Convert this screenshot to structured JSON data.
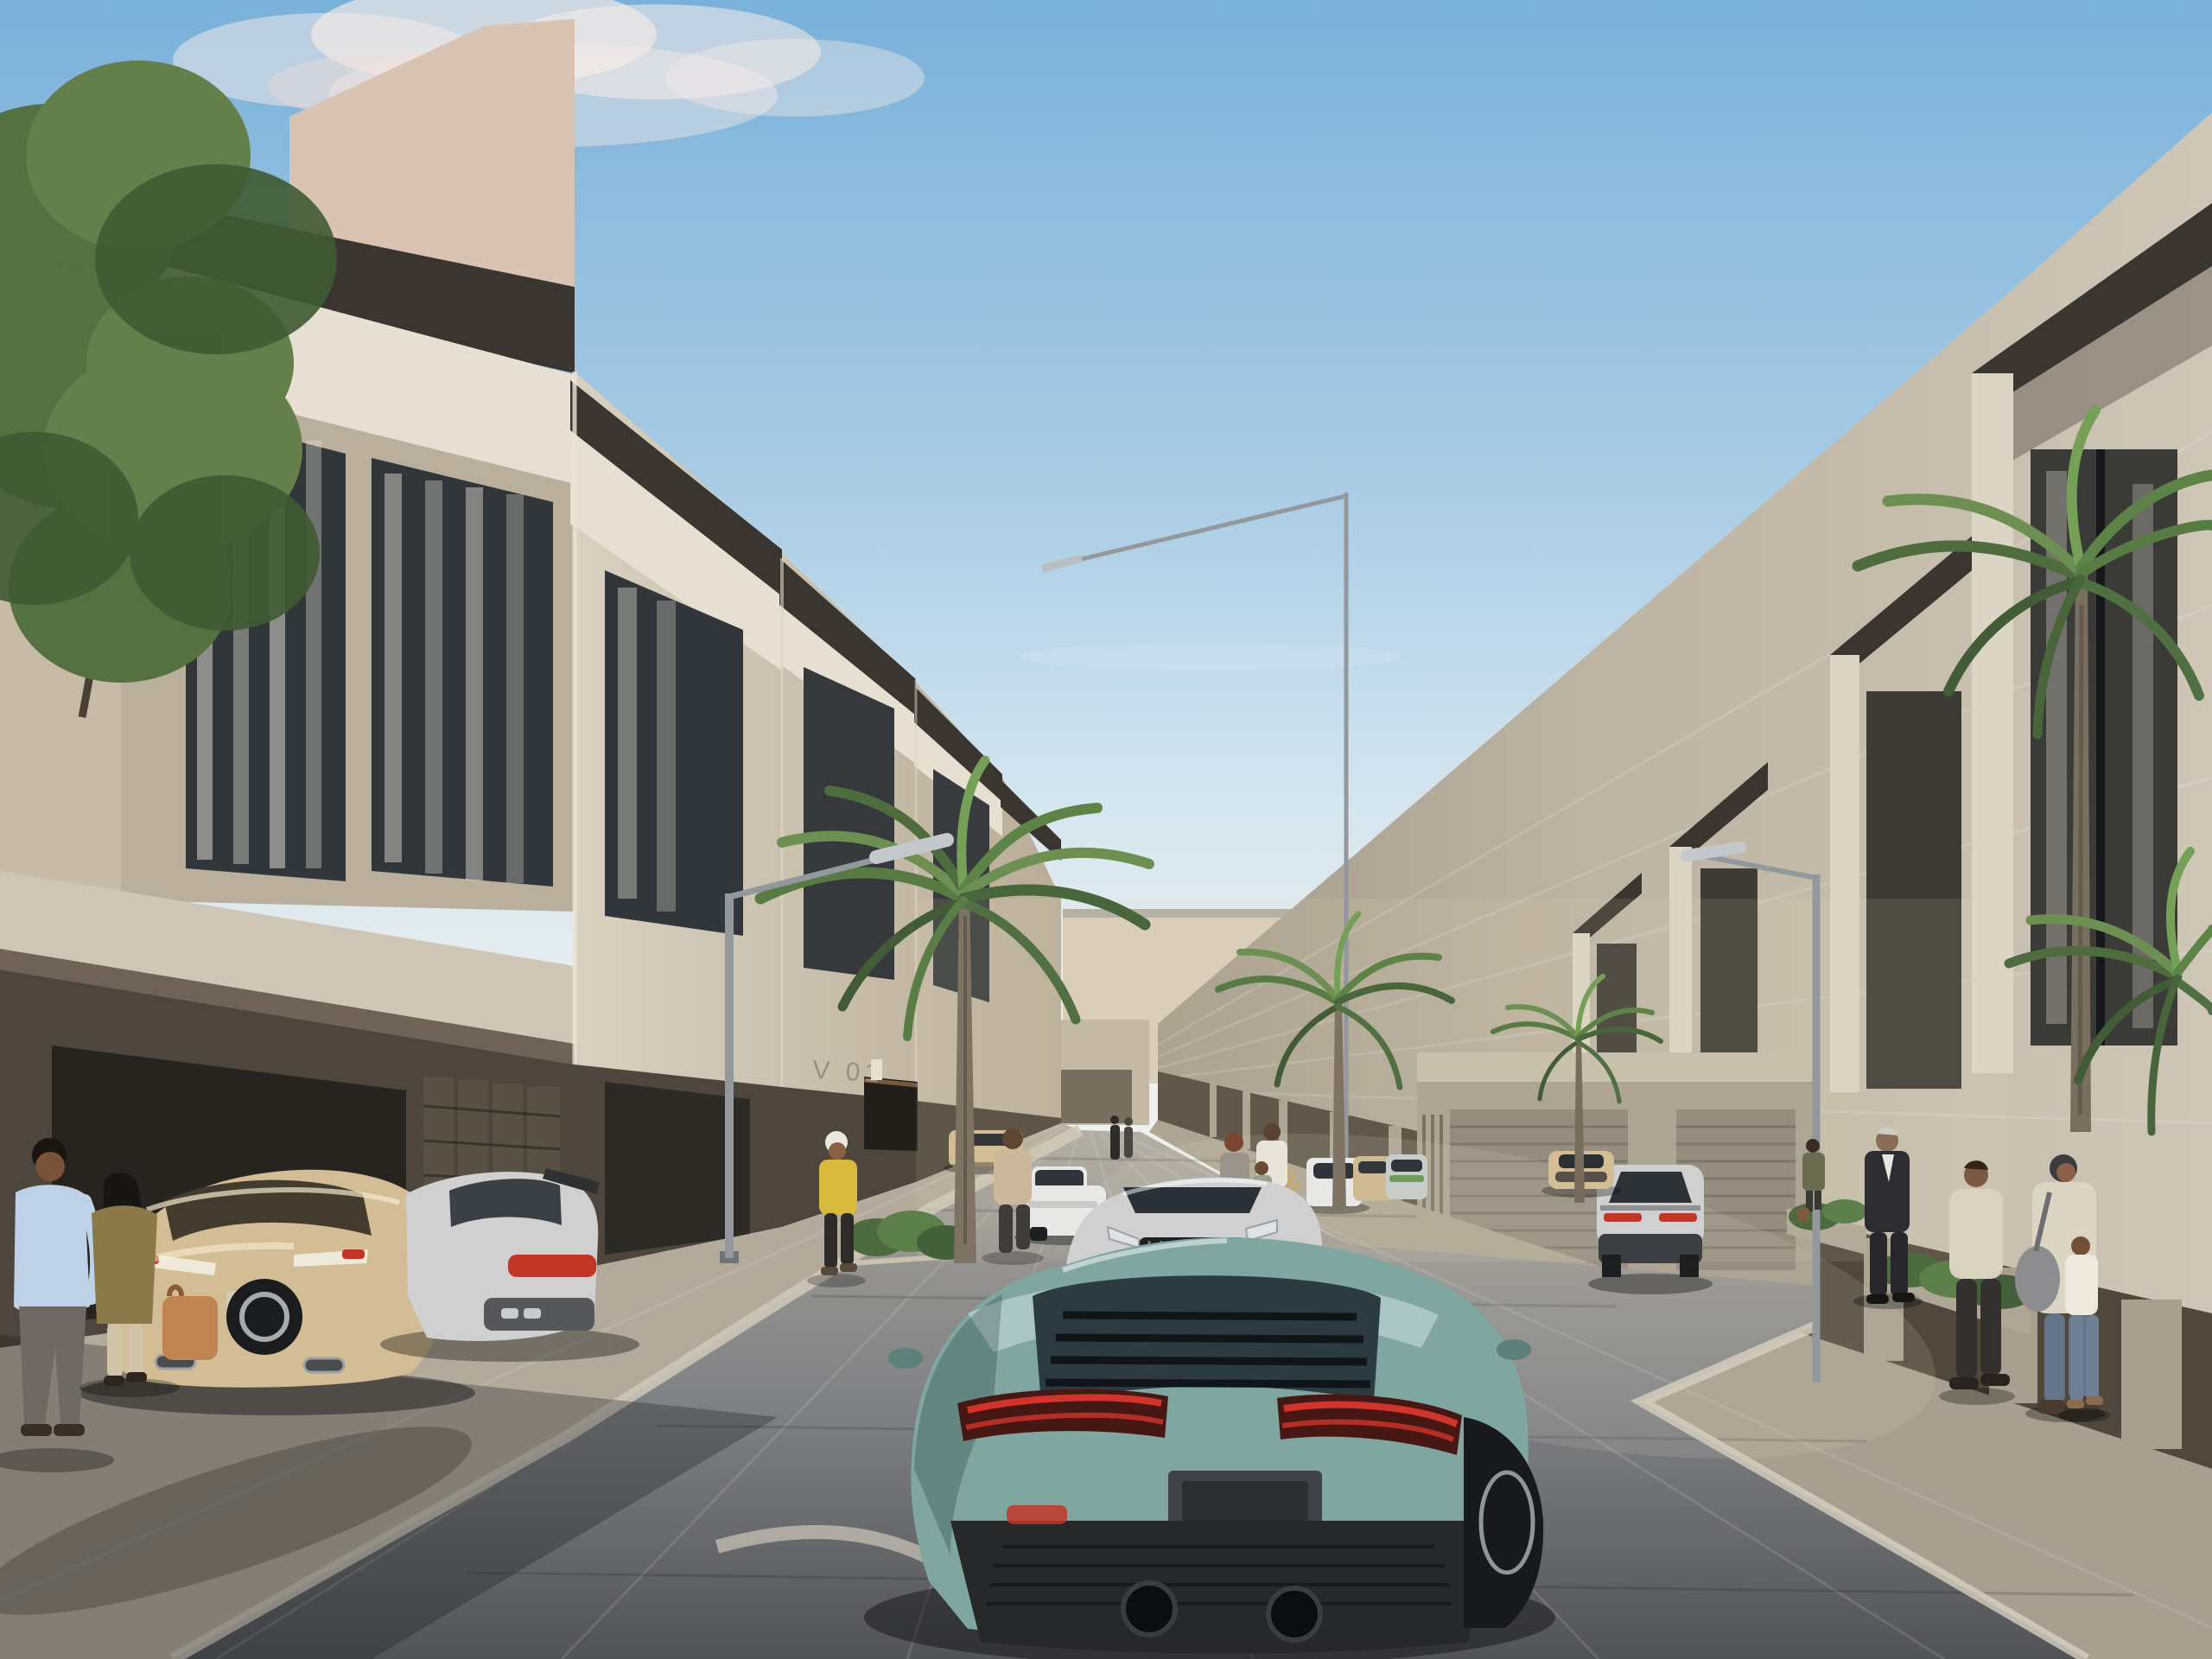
{
  "scene": {
    "type": "photorealistic architectural rendering",
    "title": "Modern villa street rendering",
    "description": "Sunlit residential street lined with modern limestone townhouses with dark pergola roof canopies. A teal sports car drives up the paved road; luxury cars are parked in carports and along the curb; pedestrians walk both sidewalks; palm trees and a leafy tree frame the view; a flock of birds flies in the blue sky above the far garages.",
    "time_of_day": "daytime",
    "weather": "clear blue sky with soft clouds"
  },
  "signs": {
    "unit_label": "V 01",
    "unit_label_location": "dark stone entrance wall of first villa",
    "far_plaques": 2
  },
  "colors": {
    "sky_top": "#7ab1da",
    "sky_horizon": "#edf1f0",
    "cloud": "#f7ece7",
    "stone_light": "#d9d0c0",
    "stone_parapet": "#e7e0d2",
    "stone_shadow": "#b3a794",
    "stucco_top": "#d9c3b2",
    "pergola_dark": "#3a352e",
    "cladding_dark": "#4e463c",
    "right_facade": "#cfc6b7",
    "arcade_dark": "#51483d",
    "pier_stone": "#a99f8f",
    "end_wall": "#a79d8e",
    "garage_door": "#8d8478",
    "distant_wall": "#d8ccba",
    "road_near": "#515357",
    "road_far": "#b2ada3",
    "sidewalk_left": "#b3aa9b",
    "sidewalk_right": "#a89f90",
    "curb": "#d3ccbd",
    "palm_green": "#5f7f46",
    "palm_dark": "#415c37",
    "tree_green": "#5d7c49",
    "car_teal": "#7fa6a1",
    "car_silver": "#cfd0cf",
    "car_champagne": "#d3bd94",
    "car_white": "#e8e9e7",
    "taillight_red": "#c23527",
    "lamp_metal": "#93989c"
  },
  "vehicles": [
    {
      "name": "teal-sports-car",
      "color": "sage teal",
      "position": "foreground center, driving away"
    },
    {
      "name": "silver-sedan",
      "color": "silver",
      "position": "mid street, facing viewer"
    },
    {
      "name": "white-suv",
      "color": "white",
      "position": "parked at left curb"
    },
    {
      "name": "champagne-coupe",
      "color": "champagne gold",
      "position": "foreground left carport"
    },
    {
      "name": "silver-coupe",
      "color": "silver",
      "position": "foreground left carport, beside coupe"
    },
    {
      "name": "gold-sports-car",
      "color": "gold",
      "position": "far end near garages, facing viewer"
    },
    {
      "name": "silver-fastback",
      "color": "silver",
      "position": "far end, driving toward garages"
    },
    {
      "name": "parked-row",
      "color": "white, champagne and green",
      "position": "right side in the distance"
    },
    {
      "name": "distant-parked-car",
      "color": "champagne",
      "position": "far left curb"
    }
  ],
  "people": [
    {
      "name": "man-blue-shirt",
      "detail": "light blue shirt, gray trousers",
      "position": "foreground left sidewalk"
    },
    {
      "name": "woman-olive-coat",
      "detail": "long dark hair, olive coat, tan handbag",
      "position": "foreground left, walking away"
    },
    {
      "name": "woman-yellow-top",
      "detail": "white cap, mustard top",
      "position": "left sidewalk mid distance"
    },
    {
      "name": "man-beige-tshirt",
      "detail": "beige t-shirt, dark trousers",
      "position": "left sidewalk by white SUV"
    },
    {
      "name": "woman-gray-top",
      "detail": "auburn hair",
      "position": "behind silver sedan"
    },
    {
      "name": "man-white-shirt-with-child",
      "detail": "white shirt, walking with child",
      "position": "behind silver sedan"
    },
    {
      "name": "businessman-suit",
      "detail": "dark suit, silver hair",
      "position": "right sidewalk, distance"
    },
    {
      "name": "man-cream-sweater",
      "detail": "cream sweater, dark trousers",
      "position": "right sidewalk"
    },
    {
      "name": "woman-headscarf",
      "detail": "cream cardigan, jeans, gray shoulder bag",
      "position": "right sidewalk"
    },
    {
      "name": "child-white-top",
      "detail": "white top, jeans",
      "position": "right sidewalk beside woman"
    },
    {
      "name": "woman-standing-planter",
      "detail": "olive top, bag on ground",
      "position": "across street near planter"
    },
    {
      "name": "distant-pedestrians",
      "detail": "two small figures",
      "position": "near street end"
    }
  ],
  "vegetation": {
    "palms": 5,
    "street_tree": "leafy green tree at top left",
    "planter_shrubs": "low shrubs in stone planters on both sidewalks"
  },
  "street_furniture": {
    "street_lamps": 3,
    "lamp_style": "silver linear LED arm on slim pole"
  },
  "birds": {
    "count": 18,
    "area": "sky above right side of street"
  }
}
